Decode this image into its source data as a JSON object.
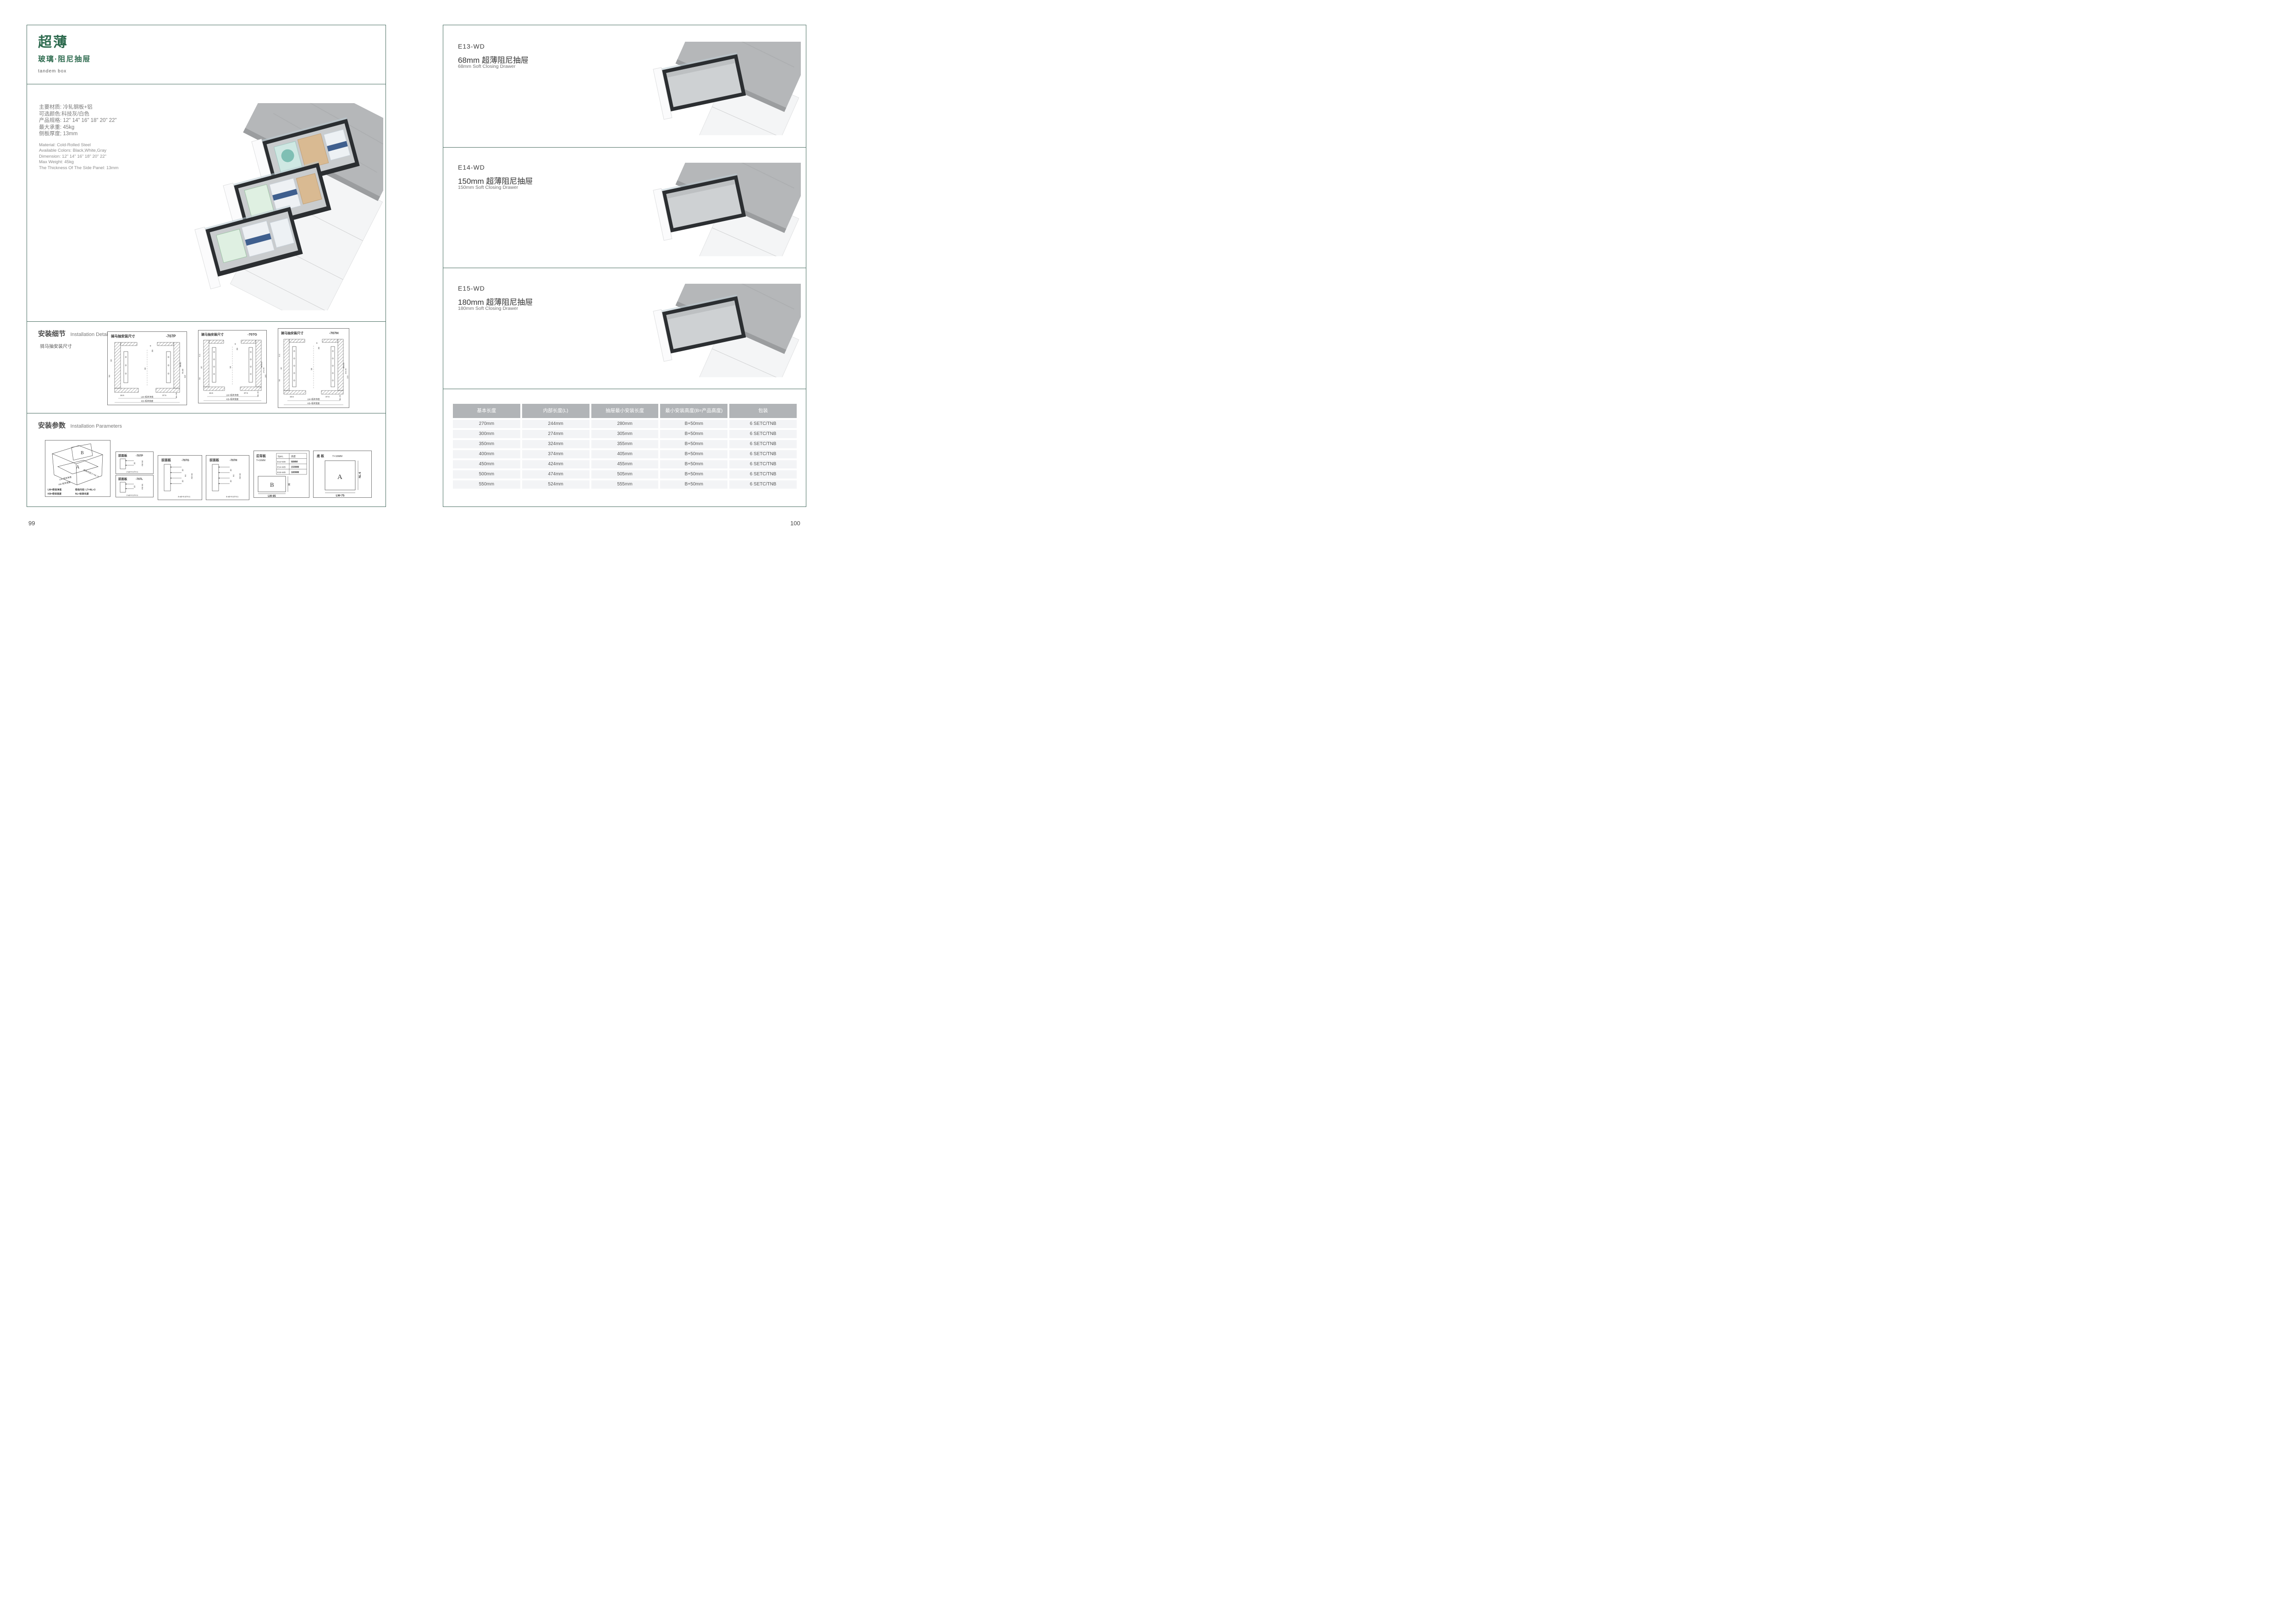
{
  "colors": {
    "accent_green": "#2e6b4f",
    "border_teal": "#4a6e62",
    "table_header_bg": "#b1b4b7",
    "table_row_bg": "#f3f4f6",
    "countertop_gray": "#b5b7b9",
    "drawer_dark": "#2b2e31"
  },
  "left": {
    "page_number": "99",
    "title": {
      "cn": "超薄",
      "sub": "玻璃·阻尼抽屉",
      "en": "tandem box"
    },
    "specs_cn": [
      "主要材质: 冷轧钢板+铝",
      "可选颜色:科技灰/白色",
      "产品规格: 12\" 14\" 16\" 18\" 20\" 22\"",
      "最大承重: 45kg",
      "侧板厚度; 13mm"
    ],
    "specs_en": [
      "Material: Cold-Rolled Steel",
      "Available Colors: Black,White,Gray",
      "Dimension: 12\" 14\" 16\" 18\" 20\" 22\"",
      "Max Weight: 45kg",
      "The Thickness Of The Side Panel: 13mm"
    ],
    "details": {
      "heading_cn": "安装细节",
      "heading_en": "Installation Details",
      "subheading": "骑马抽安装尺寸",
      "diagrams": [
        {
          "title": "骑马抽安装尺寸",
          "model": "-707P",
          "dims": {
            "top1": "9",
            "top2": "20",
            "la": "32",
            "lb": "54",
            "lc": "",
            "center": "16",
            "bl": "16.5",
            "br": "37.5",
            "r1": "Min82",
            "r2": "91.50",
            "r3": "113",
            "rb": "Min 36",
            "lw": "LW=柜体净宽",
            "kb": "KB=柜体宽度"
          }
        },
        {
          "title": "骑马抽安装尺寸",
          "model": "-707G",
          "dims": {
            "top1": "9",
            "top2": "20",
            "la": "32",
            "lb": "54",
            "lc": "6.4",
            "center": "16",
            "bl": "16.5",
            "br": "37.5",
            "r1": "Min162",
            "r2": "171.50",
            "r3": "195",
            "rb": "Min 36",
            "lw": "LW=柜体净宽",
            "kb": "KB=柜体宽度"
          }
        },
        {
          "title": "骑马抽安装尺寸",
          "model": "-707H",
          "dims": {
            "top1": "9",
            "top2": "20",
            "la": "32",
            "lb": "54",
            "lc": "6.4",
            "center": "16",
            "bl": "16.5",
            "br": "37.5",
            "r1": "Min192",
            "r2": "201.50",
            "r3": "225",
            "rb": "Min 36",
            "lw": "LW=柜体净宽",
            "kb": "KB=柜体宽度"
          }
        }
      ]
    },
    "params": {
      "heading_cn": "安装参数",
      "heading_en": "Installation Parameters",
      "iso": {
        "letter_a": "A",
        "letter_b": "B",
        "edge_lw": "LW=柜体净宽",
        "edge_kb": "KB=柜体宽度",
        "edge_lt": "柜体内空LT=NL+3",
        "legend1": "LW=柜体净宽",
        "legend2": "柜体内空: LT=NL+3",
        "legend3": "KB=柜体宽度",
        "legend4": "NL=标准长度"
      },
      "fp1": {
        "title": "前面板",
        "model": "-707P",
        "d1": "32",
        "d2": "min 54",
        "note": "2-ø2+0.2/-0.1"
      },
      "fp2": {
        "title": "前面板",
        "model": "-707L",
        "d1": "32",
        "d2": "min 54",
        "note": "2-ø2+0.2/-0.1"
      },
      "fp3": {
        "title": "前面板",
        "model": "-707G",
        "d1": "32",
        "d2": "64",
        "d3": "32",
        "d4": "min 54",
        "note": "4-ø2+0.2/-0.1"
      },
      "fp4": {
        "title": "前面板",
        "model": "-707H",
        "d1": "32",
        "d2": "64",
        "d3": "32",
        "d4": "min 54",
        "note": "4-ø2+0.2/-0.1"
      },
      "back": {
        "title": "后背板",
        "thickness": "T=16MM",
        "spec_h1": "Spec.",
        "spec_h2": "高度",
        "r0c0": "E13-WD",
        "r0c1": "68MM",
        "r1c0": "E14-WD",
        "r1c1": "150MM",
        "r2c0": "E15-WD",
        "r2c1": "180MM",
        "letter": "B",
        "h": "H",
        "w": "LW-85"
      },
      "bottom": {
        "title": "底 板",
        "thickness": "T=16MM",
        "letter": "A",
        "h": "NL-6",
        "w": "LW-75"
      }
    }
  },
  "right": {
    "page_number": "100",
    "sections": [
      {
        "model": "E13-WD",
        "cn": "68mm 超薄阻尼抽屉",
        "en": "68mm Soft Closing Drawer"
      },
      {
        "model": "E14-WD",
        "cn": "150mm 超薄阻尼抽屉",
        "en": "150mm Soft Closing Drawer"
      },
      {
        "model": "E15-WD",
        "cn": "180mm 超薄阻尼抽屉",
        "en": "180mm Soft Closing Drawer"
      }
    ],
    "table": {
      "headers": [
        "基本长度",
        "内部长度(L)",
        "抽屉最小安装长度",
        "最小安装高度(B=产品高度)",
        "包装"
      ],
      "rows": [
        [
          "270mm",
          "244mm",
          "280mm",
          "B+50mm",
          "6 SETC/TNB"
        ],
        [
          "300mm",
          "274mm",
          "305mm",
          "B+50mm",
          "6 SETC/TNB"
        ],
        [
          "350mm",
          "324mm",
          "355mm",
          "B+50mm",
          "6 SETC/TNB"
        ],
        [
          "400mm",
          "374mm",
          "405mm",
          "B+50mm",
          "6 SETC/TNB"
        ],
        [
          "450mm",
          "424mm",
          "455mm",
          "B+50mm",
          "6 SETC/TNB"
        ],
        [
          "500mm",
          "474mm",
          "505mm",
          "B+50mm",
          "6 SETC/TNB"
        ],
        [
          "550mm",
          "524mm",
          "555mm",
          "B+50mm",
          "6 SETC/TNB"
        ]
      ]
    }
  }
}
